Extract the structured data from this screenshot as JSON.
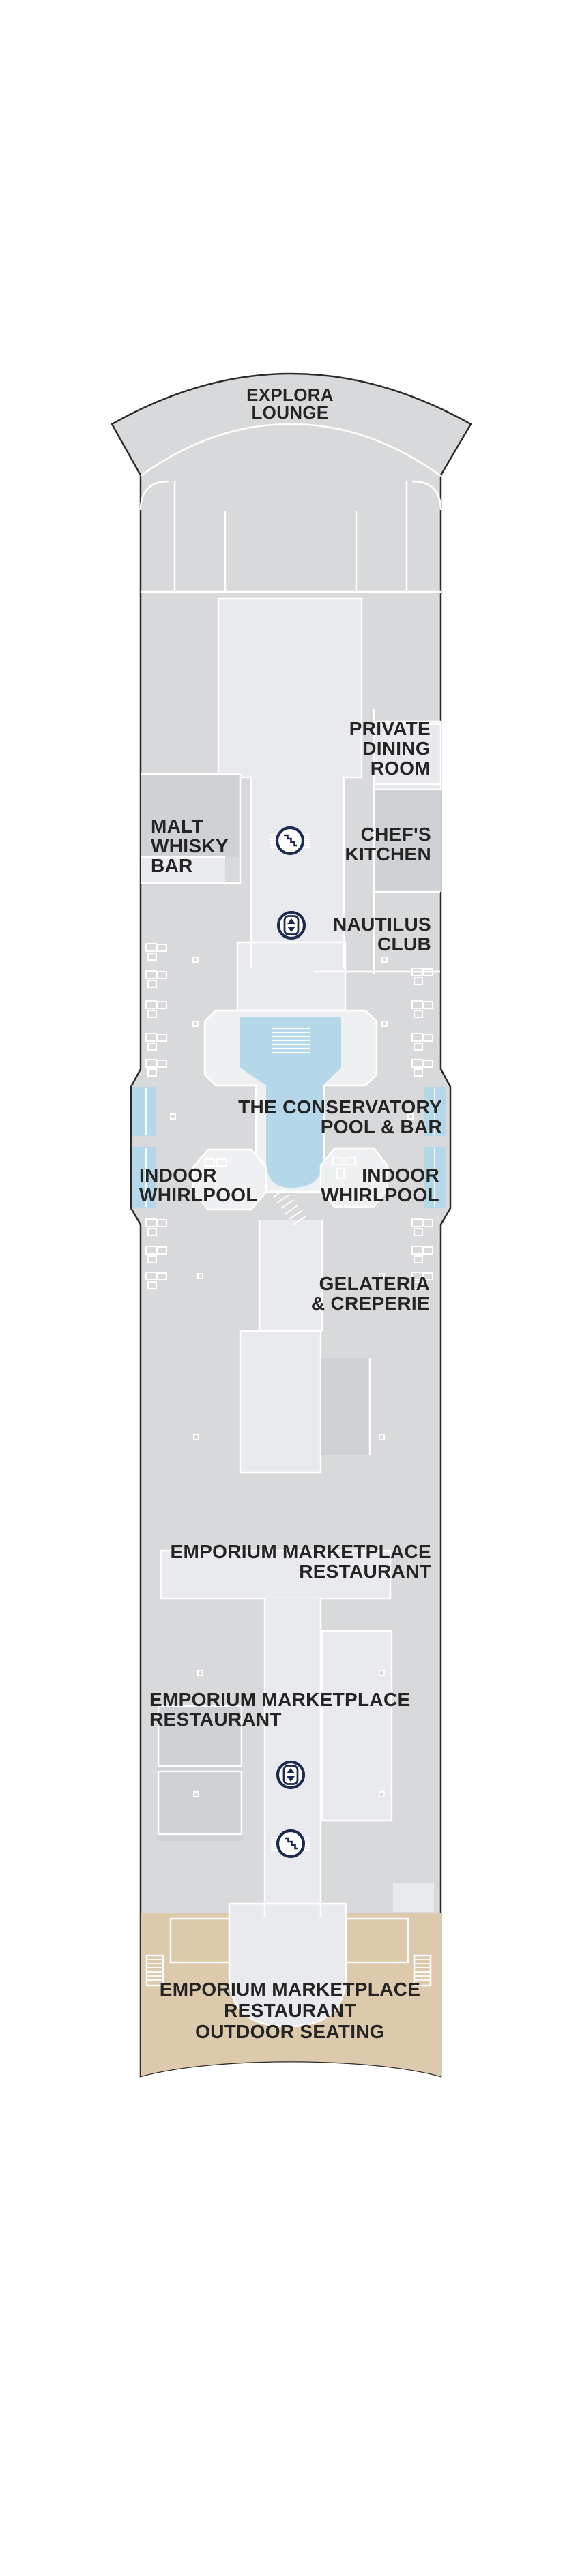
{
  "colors": {
    "background": "#ffffff",
    "hull_fill": "#d7d9db",
    "hull_outline": "#2b2b2b",
    "room_light": "#e8eaed",
    "room_lighter": "#eef0f2",
    "room_dark": "#cfd2d5",
    "wall": "#ffffff",
    "pool_blue": "#b4d8e9",
    "outdoor_tan": "#ddc9ac",
    "icon_navy": "#1d2c4e",
    "label_text": "#242424"
  },
  "labels": {
    "explora_lounge": {
      "text": "EXPLORA\nLOUNGE"
    },
    "private_dining_room": {
      "text": "PRIVATE\nDINING\nROOM"
    },
    "malt_whisky_bar": {
      "text": "MALT\nWHISKY\nBAR"
    },
    "chefs_kitchen": {
      "text": "CHEF'S\nKITCHEN"
    },
    "nautilus_club": {
      "text": "NAUTILUS\nCLUB"
    },
    "conservatory_pool_bar": {
      "text": "THE CONSERVATORY\nPOOL & BAR"
    },
    "indoor_whirlpool_left": {
      "text": "INDOOR\nWHIRLPOOL"
    },
    "indoor_whirlpool_right": {
      "text": "INDOOR\nWHIRLPOOL"
    },
    "gelateria_creperie": {
      "text": "GELATERIA\n& CREPERIE"
    },
    "emporium_marketplace_upper": {
      "text": "EMPORIUM MARKETPLACE\nRESTAURANT"
    },
    "emporium_marketplace_lower": {
      "text": "EMPORIUM MARKETPLACE\nRESTAURANT"
    },
    "emporium_outdoor_seating": {
      "text": "EMPORIUM MARKETPLACE\nRESTAURANT\nOUTDOOR SEATING"
    }
  },
  "icons": {
    "stairs": "stairs-icon",
    "elevator": "elevator-icon",
    "stairs_count": 2,
    "elevator_count": 2
  }
}
